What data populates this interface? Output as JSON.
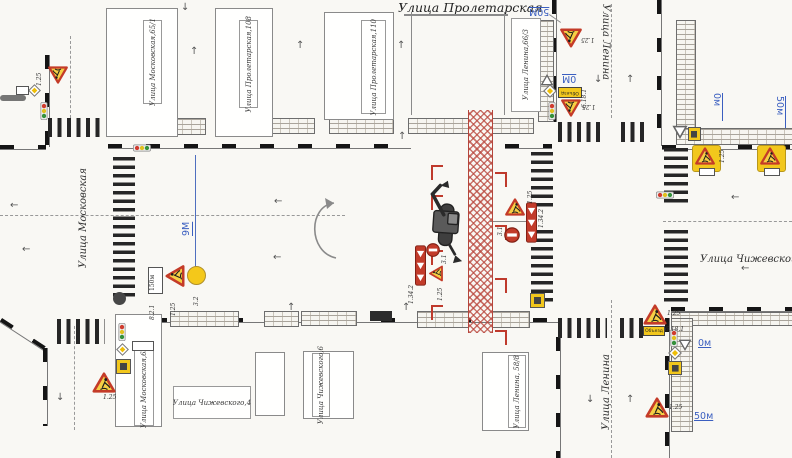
{
  "title": "Улица Пролетарская",
  "streets": {
    "moskovskaya": "Улица Московская",
    "lenina_north": "Улица Ленина",
    "lenina_south": "Улица Ленина",
    "chizhevskogo": "Улица Чижевского"
  },
  "buildings": {
    "b1": "Улица Московская,65/1",
    "b2": "Улица Пролетарская,108",
    "b3": "Улица Пролетарская,110",
    "b4": "Улица Ленина,66/3",
    "b5": "Улица Московская,63",
    "b6": "Улица Чижевского,4",
    "b7": "Улица Чижевского,6",
    "b8": "Улица Ленина, 58/8"
  },
  "sign_codes": {
    "roadworks": "1.25",
    "no_entry": "3.1",
    "chevron": "1.34.2",
    "distance_plate": "8.2.1",
    "detour": "6.18.1",
    "signal": "3.2",
    "plate_150m": "150м",
    "detour_text": "Объезд"
  },
  "markers": {
    "left_9m": "9М",
    "top_50m": "50М",
    "top_0m": "0М",
    "right_0m": "0м",
    "right_50m": "50м",
    "bottom_0m": "0м",
    "bottom_50m": "50м"
  },
  "icons": {
    "arrow_up": "↑",
    "arrow_down": "↓",
    "arrow_left": "←"
  },
  "colors": {
    "trench_red": "#b5463c",
    "sign_red": "#c23b2a",
    "sign_yellow": "#f2c71c",
    "marker_blue": "#3b5fc0"
  }
}
